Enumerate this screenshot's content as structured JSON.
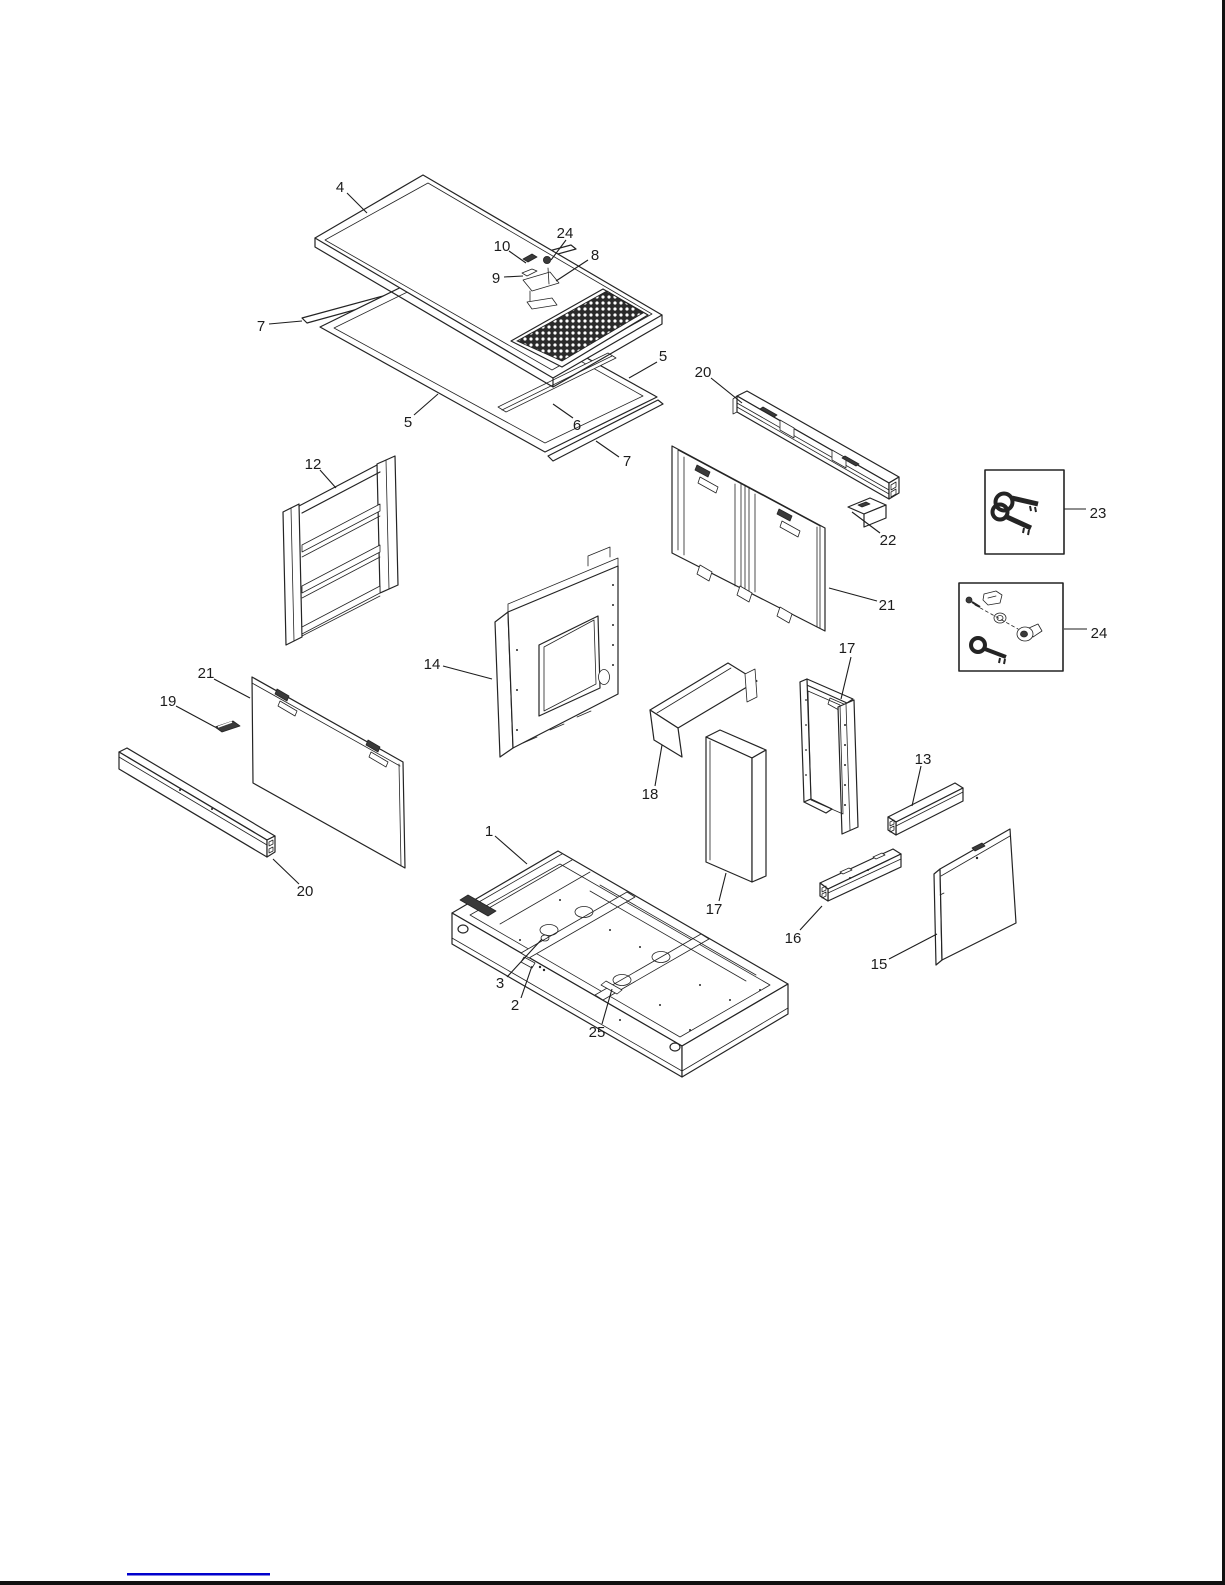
{
  "colors": {
    "ink": "#242424",
    "link_blue": "#0000cc",
    "page_border": "#111111"
  },
  "diagram": {
    "type": "exploded-parts-diagram",
    "callouts": [
      {
        "label": "4",
        "part": "top-panel",
        "x": 340,
        "y": 187,
        "leader": [
          347,
          193,
          367,
          213
        ]
      },
      {
        "label": "10",
        "part": "latch-screw",
        "x": 502,
        "y": 246,
        "leader": [
          509,
          251,
          526,
          263
        ]
      },
      {
        "label": "24",
        "part": "lock-cylinder-top",
        "x": 565,
        "y": 233,
        "leader": [
          566,
          240,
          551,
          260
        ]
      },
      {
        "label": "8",
        "part": "latch-plate",
        "x": 595,
        "y": 255,
        "leader": [
          588,
          260,
          556,
          281
        ]
      },
      {
        "label": "9",
        "part": "latch-clip",
        "x": 496,
        "y": 278,
        "leader": [
          504,
          277,
          523,
          276
        ]
      },
      {
        "label": "7",
        "part": "gasket-strip-upper",
        "x": 261,
        "y": 326,
        "leader": [
          269,
          324,
          302,
          321
        ]
      },
      {
        "label": "5",
        "part": "side-rail-left",
        "x": 408,
        "y": 422,
        "leader": [
          414,
          415,
          438,
          394
        ]
      },
      {
        "label": "6",
        "part": "cross-rail",
        "x": 577,
        "y": 425,
        "leader": [
          573,
          418,
          553,
          404
        ]
      },
      {
        "label": "5",
        "part": "side-rail-right",
        "x": 663,
        "y": 356,
        "leader": [
          657,
          362,
          629,
          378
        ]
      },
      {
        "label": "7",
        "part": "gasket-strip-lower",
        "x": 627,
        "y": 461,
        "leader": [
          619,
          457,
          596,
          441
        ]
      },
      {
        "label": "20",
        "part": "upper-support-rail",
        "x": 703,
        "y": 372,
        "leader": [
          711,
          378,
          742,
          403
        ]
      },
      {
        "label": "22",
        "part": "small-bracket",
        "x": 888,
        "y": 540,
        "leader": [
          880,
          533,
          852,
          512
        ]
      },
      {
        "label": "21",
        "part": "double-door-panel",
        "x": 887,
        "y": 605,
        "leader": [
          877,
          601,
          829,
          588
        ]
      },
      {
        "label": "23",
        "part": "key-set",
        "x": 1098,
        "y": 513,
        "leader": [
          1086,
          509,
          1064,
          509
        ]
      },
      {
        "label": "24",
        "part": "lock-kit",
        "x": 1099,
        "y": 633,
        "leader": [
          1087,
          629,
          1064,
          629
        ]
      },
      {
        "label": "12",
        "part": "louver-panel",
        "x": 313,
        "y": 464,
        "leader": [
          320,
          470,
          336,
          488
        ]
      },
      {
        "label": "14",
        "part": "window-panel",
        "x": 432,
        "y": 664,
        "leader": [
          443,
          666,
          492,
          679
        ]
      },
      {
        "label": "17",
        "part": "corner-frame-right",
        "x": 847,
        "y": 648,
        "leader": [
          851,
          657,
          841,
          699
        ]
      },
      {
        "label": "18",
        "part": "deflector-hood",
        "x": 650,
        "y": 794,
        "leader": [
          655,
          786,
          662,
          745
        ]
      },
      {
        "label": "17",
        "part": "corner-post-center",
        "x": 714,
        "y": 909,
        "leader": [
          719,
          901,
          726,
          873
        ]
      },
      {
        "label": "13",
        "part": "short-rail",
        "x": 923,
        "y": 759,
        "leader": [
          921,
          766,
          912,
          806
        ]
      },
      {
        "label": "19",
        "part": "clip-plate",
        "x": 168,
        "y": 701,
        "leader": [
          176,
          706,
          215,
          727
        ]
      },
      {
        "label": "21",
        "part": "side-panel-left",
        "x": 206,
        "y": 673,
        "leader": [
          214,
          679,
          250,
          698
        ]
      },
      {
        "label": "20",
        "part": "lower-support-rail",
        "x": 305,
        "y": 891,
        "leader": [
          299,
          884,
          273,
          859
        ]
      },
      {
        "label": "1",
        "part": "base-frame",
        "x": 489,
        "y": 831,
        "leader": [
          495,
          836,
          527,
          864
        ]
      },
      {
        "label": "3",
        "part": "base-grommet",
        "x": 500,
        "y": 983,
        "leader": [
          507,
          977,
          542,
          939
        ]
      },
      {
        "label": "2",
        "part": "base-plate",
        "x": 515,
        "y": 1005,
        "leader": [
          521,
          998,
          532,
          966
        ]
      },
      {
        "label": "25",
        "part": "base-bracket",
        "x": 597,
        "y": 1032,
        "leader": [
          602,
          1024,
          612,
          989
        ]
      },
      {
        "label": "16",
        "part": "lower-bracket-rail",
        "x": 793,
        "y": 938,
        "leader": [
          800,
          930,
          822,
          906
        ]
      },
      {
        "label": "15",
        "part": "access-panel",
        "x": 879,
        "y": 964,
        "leader": [
          889,
          959,
          937,
          934
        ]
      }
    ]
  }
}
